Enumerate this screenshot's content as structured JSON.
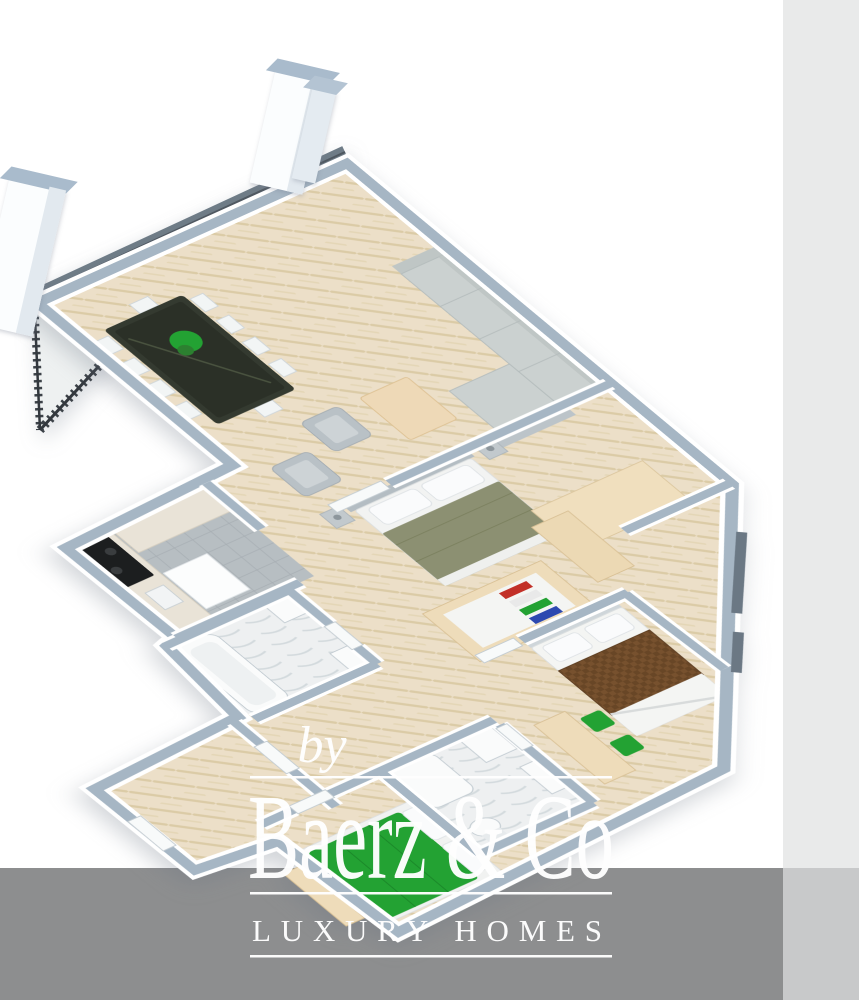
{
  "watermark": {
    "prefix": "by",
    "brand": "Baerz & Co",
    "tagline": "LUXURY HOMES"
  },
  "colors": {
    "background": "#ffffff",
    "strip_right": "#e9eaea",
    "band_bottom": "#8d8e8f",
    "corner_bottom_right": "#c8c9ca",
    "wall_top": "#a6b6c4",
    "wall_side": "#ffffff",
    "parquet": "#ecdfc8",
    "accent_green": "#23a233",
    "bed_olive": "#8c9072",
    "blanket_brown": "#77512e",
    "wood_beige": "#eedcba",
    "sofa_gray": "#cbd1d0",
    "glass_dark": "#6f7c87",
    "railing_dark": "#3c4248",
    "watermark_white": "#ffffff"
  },
  "floorplan": {
    "type": "3d-apartment-floor-plan",
    "rooms": [
      "balcony",
      "living-room",
      "dining-area",
      "kitchen",
      "master-bedroom",
      "walk-in-closet",
      "bathroom-1",
      "single-bedroom",
      "bathroom-2",
      "second-bedroom",
      "entrance-hall"
    ]
  }
}
